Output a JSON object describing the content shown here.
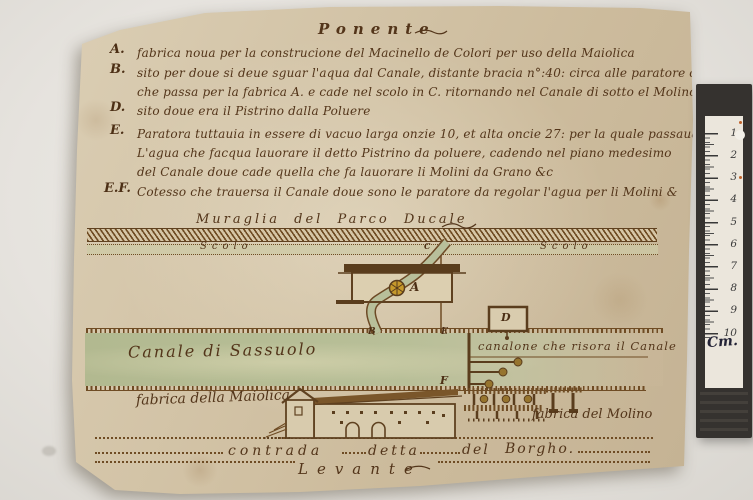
{
  "scene": {
    "background_color": "#e6e3de",
    "paper_color": "#d3c3a5",
    "ink_color": "#53351a",
    "canal_green": "#b6bc95",
    "wheel_yellow": "#c6992b",
    "ruler_frame_color": "#35322f"
  },
  "document": {
    "title_top": "Ponente",
    "title_bottom": "Levante",
    "legend": [
      {
        "key": "A.",
        "text": "fabrica noua per la construcione del Macinello de Colori per uso della Maiolica"
      },
      {
        "key": "B.",
        "text": "sito per doue si deue sguar l'aqua dal Canale, distante bracia n°:40: circa alle paratore del Molino"
      },
      {
        "key": "",
        "text": "che passa per la fabrica A. e cade nel scolo in C. ritornando nel Canale di sotto el Molino per°:50:&c"
      },
      {
        "key": "D.",
        "text": "sito doue era il Pistrino dalla Poluere"
      },
      {
        "key": "E.",
        "text": "Paratora tuttauia in essere di vacuo larga onzie 10, et alta oncie 27: per la quale passaua"
      },
      {
        "key": "",
        "text": "L'agua che facqua lauorare il detto Pistrino da poluere, cadendo nel piano medesimo"
      },
      {
        "key": "",
        "text": "del Canale doue cade quella che fa lauorare li Molini da Grano &c"
      },
      {
        "key": "E.F.",
        "text": "Cotesso che trauersa il Canale doue sono le paratore da regolar l'agua per li Molini &"
      }
    ],
    "labels": {
      "muraglia": "Muraglia del Parco Ducale",
      "scolo_left": "Scolo",
      "scolo_right": "Scolo",
      "canale": "Canale di Sassuolo",
      "canalone": "canalone che risora il Canale",
      "fabrica_maiolica": "fabrica della Maiolica",
      "fabrica_molino": "fabrica del Molino"
    },
    "plan_letters": {
      "a": "A",
      "b": "B",
      "c": "C",
      "d": "D",
      "e": "E",
      "f": "F"
    },
    "road": {
      "words": [
        "contrada",
        "detta",
        "del",
        "Borgho."
      ]
    }
  },
  "ruler": {
    "numbers": [
      "1",
      "2",
      "3",
      "4",
      "5",
      "6",
      "7",
      "8",
      "9",
      "10"
    ],
    "unit_label": "Cm."
  }
}
